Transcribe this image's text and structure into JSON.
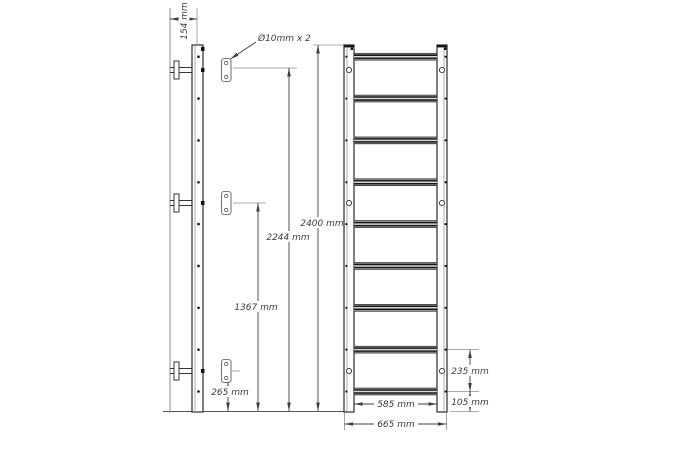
{
  "labels": {
    "side_depth": "154 mm",
    "mount_holes_callout": "Ø10mm x 2",
    "top_bracket_height": "2244 mm",
    "middle_bracket_height": "1367 mm",
    "bottom_bracket_height": "265 mm",
    "overall_height": "2400 mm",
    "bottom_rung_gap": "235 mm",
    "bottom_rung_height": "105 mm",
    "inner_width": "585 mm",
    "overall_width": "665 mm"
  },
  "structure": {
    "rungs_count": 9,
    "bracket_levels_count": 3,
    "holes_per_plate": 2
  },
  "colors": {
    "background": "#ffffff",
    "outline": "#2b2b2b",
    "dimension_line": "#3f3f3f",
    "extension_line": "#8f8f8f",
    "text": "#3a3a3a",
    "rung_dark": "#161616",
    "rung_highlight": "#d8d8d8"
  }
}
